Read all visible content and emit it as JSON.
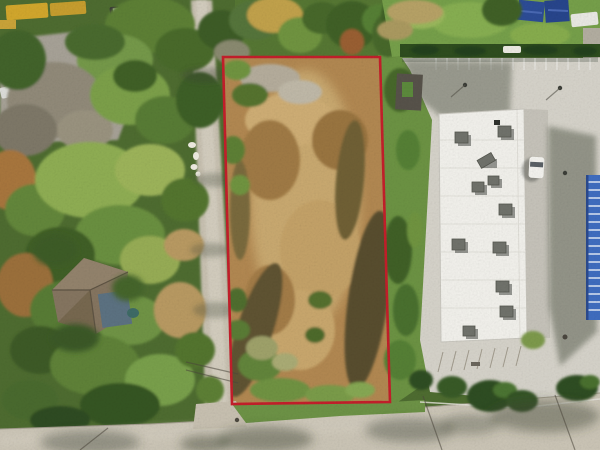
{
  "scene": {
    "kind": "aerial-drone-photograph",
    "subject": "vacant brush-covered land parcel outlined in red, bordered by a tree-lined street and wooded lots on the left and a commercial building with concrete parking lot on the right",
    "width": 600,
    "height": 450
  },
  "parcel": {
    "outline_points": "223,57 380,57 390,402 232,404",
    "outline_color": "#c41e2a",
    "outline_width": 2.6
  },
  "colors": {
    "canvas_base": "#4e6c30",
    "top_strip_base": "#567733",
    "right_strip_grass": "#6c9343",
    "tree_light": "#8fae52",
    "tree_dark": "#3c5c26",
    "autumn_foliage": "#a8763e",
    "brush_tan": "#b28851",
    "brush_dark": "#5e5330",
    "road_pavement": "#cbc5b6",
    "street_pavement": "#c8c1b1",
    "parking_concrete": "#d6d3ca",
    "building_roof": "#f2f1ec",
    "drive_lane": "#c6c3ba",
    "hedge_green": "#2e4d1e",
    "grass_green": "#76a04a",
    "blue_canopy": "#2c4c96",
    "blue_container": "#3f6dc0",
    "house_roof": "#857560",
    "shadow": "#39412f",
    "vehicle_yellow": "#d2a72c",
    "vehicle_white": "#e9e9e3",
    "yard_pavement": "#a7a297"
  }
}
